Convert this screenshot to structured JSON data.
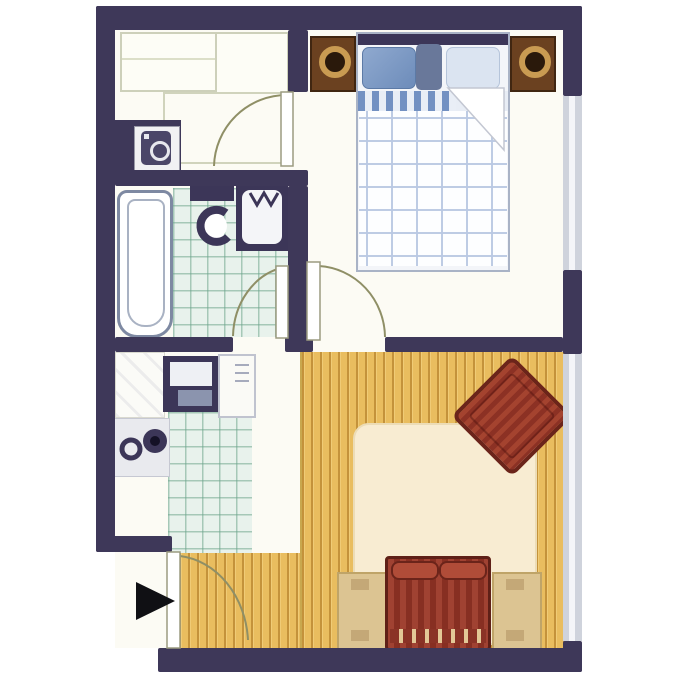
{
  "diagram": {
    "type": "apartment-floor-plan",
    "rooms": [
      {
        "name": "entry-hall",
        "features": [
          "closet",
          "closet",
          "wardrobe",
          "washing-machine"
        ]
      },
      {
        "name": "bathroom",
        "features": [
          "bathtub",
          "toilet",
          "sink-vanity",
          "tiled-floor"
        ]
      },
      {
        "name": "kitchen",
        "features": [
          "counter",
          "sink-unit",
          "appliance",
          "stove",
          "tiled-floor"
        ]
      },
      {
        "name": "bedroom",
        "features": [
          "double-bed",
          "pillows",
          "folded-duvet-corner",
          "nightstand-with-lamp-left",
          "nightstand-with-lamp-right",
          "window-right-wall"
        ]
      },
      {
        "name": "living-room",
        "features": [
          "wood-plank-floor",
          "area-rug",
          "armchair-diagonal",
          "sofa",
          "side-table-left",
          "side-table-right",
          "window-right-wall"
        ]
      }
    ],
    "doors": [
      "entry-door-bottom-left",
      "bathroom-door",
      "bedroom-door",
      "hall-door"
    ],
    "entry_marker": "black-right-pointing-arrow"
  },
  "palette": {
    "wall": "#3E3859",
    "floor": "#FCFBF4",
    "tile": "#E8F2EC",
    "tile_line": "#6EA58C",
    "wood": "#E9BD5F",
    "wood_stripe": "#96610F",
    "rug": "#F8ECD2",
    "sofa": "#8E3427",
    "armchair": "#93392B",
    "side_table": "#DCC492",
    "nightstand": "#6B4120",
    "lamp_gold": "#C99B52",
    "pillow_dark": "#7D9AC6",
    "pillow_light": "#DBE4F1",
    "duvet_grid": "#B9C8E2",
    "fixture": "#3C3658",
    "fixture_outline": "#7E89A2",
    "door_arc": "#8F8F66",
    "door_leaf_stroke": "#9B9B80",
    "window": "#CFD3DC",
    "arrow": "#101014"
  }
}
